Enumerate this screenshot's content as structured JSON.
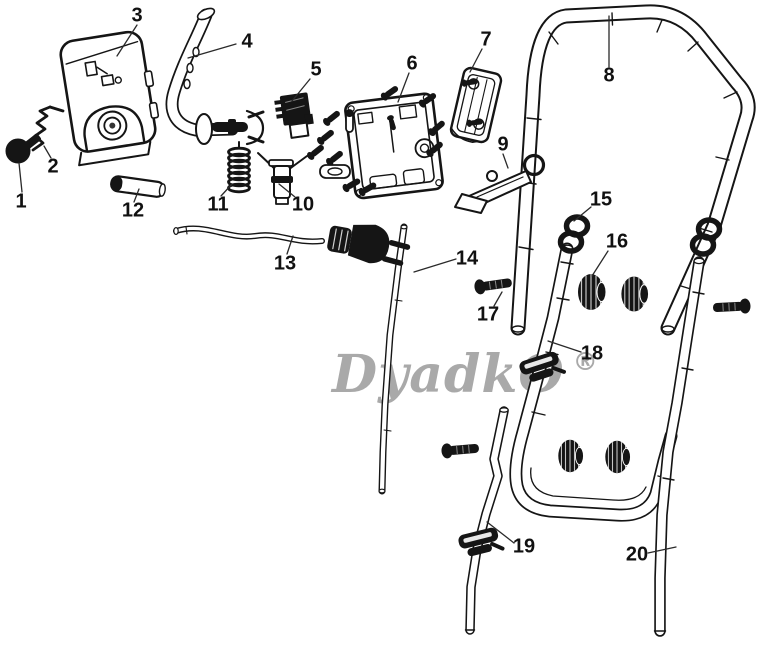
{
  "watermark": {
    "text": "DyadkO",
    "registered": "®",
    "color": "#a9a9a9"
  },
  "colors": {
    "line": "#151515",
    "background": "#ffffff",
    "label": "#111111"
  },
  "parts": [
    {
      "number": "1"
    },
    {
      "number": "2"
    },
    {
      "number": "3"
    },
    {
      "number": "4"
    },
    {
      "number": "5"
    },
    {
      "number": "6"
    },
    {
      "number": "7"
    },
    {
      "number": "8"
    },
    {
      "number": "9"
    },
    {
      "number": "10"
    },
    {
      "number": "11"
    },
    {
      "number": "12"
    },
    {
      "number": "13"
    },
    {
      "number": "14"
    },
    {
      "number": "15"
    },
    {
      "number": "16"
    },
    {
      "number": "17"
    },
    {
      "number": "18"
    },
    {
      "number": "19"
    },
    {
      "number": "20"
    }
  ]
}
